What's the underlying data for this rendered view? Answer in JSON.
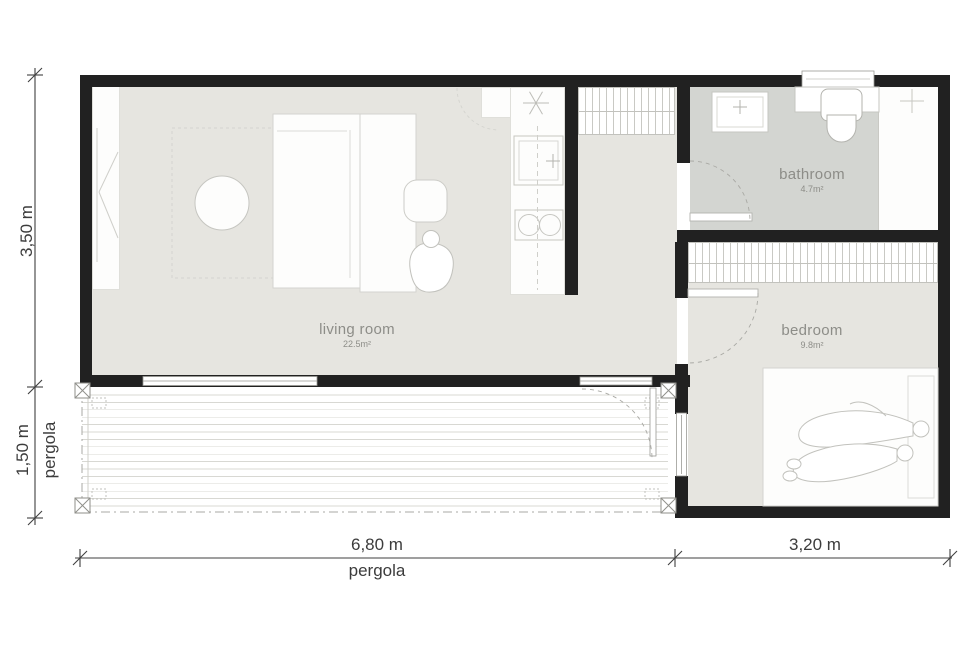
{
  "rooms": {
    "living_room": {
      "label": "living room",
      "area": "22.5m²"
    },
    "bathroom": {
      "label": "bathroom",
      "area": "4.7m²"
    },
    "bedroom": {
      "label": "bedroom",
      "area": "9.8m²"
    }
  },
  "dimensions": {
    "building_height": "3,50 m",
    "pergola_depth": "1,50 m",
    "pergola_side_label": "pergola",
    "main_width": "6,80 m",
    "bedroom_width": "3,20 m",
    "pergola_bottom_label": "pergola"
  },
  "icons": {
    "cooker_hood": "asterisk-hood-symbol",
    "sink_faucet": "cross-faucet-symbol",
    "shower_faucet": "cross-faucet-symbol"
  },
  "colors": {
    "wall": "#212121",
    "floor_main": "#e6e5e0",
    "floor_bathroom": "#d3d5d1",
    "label_text": "#8d8d88",
    "dimension_text": "#3c3c3c",
    "furniture_stroke": "#c6c6c1"
  }
}
